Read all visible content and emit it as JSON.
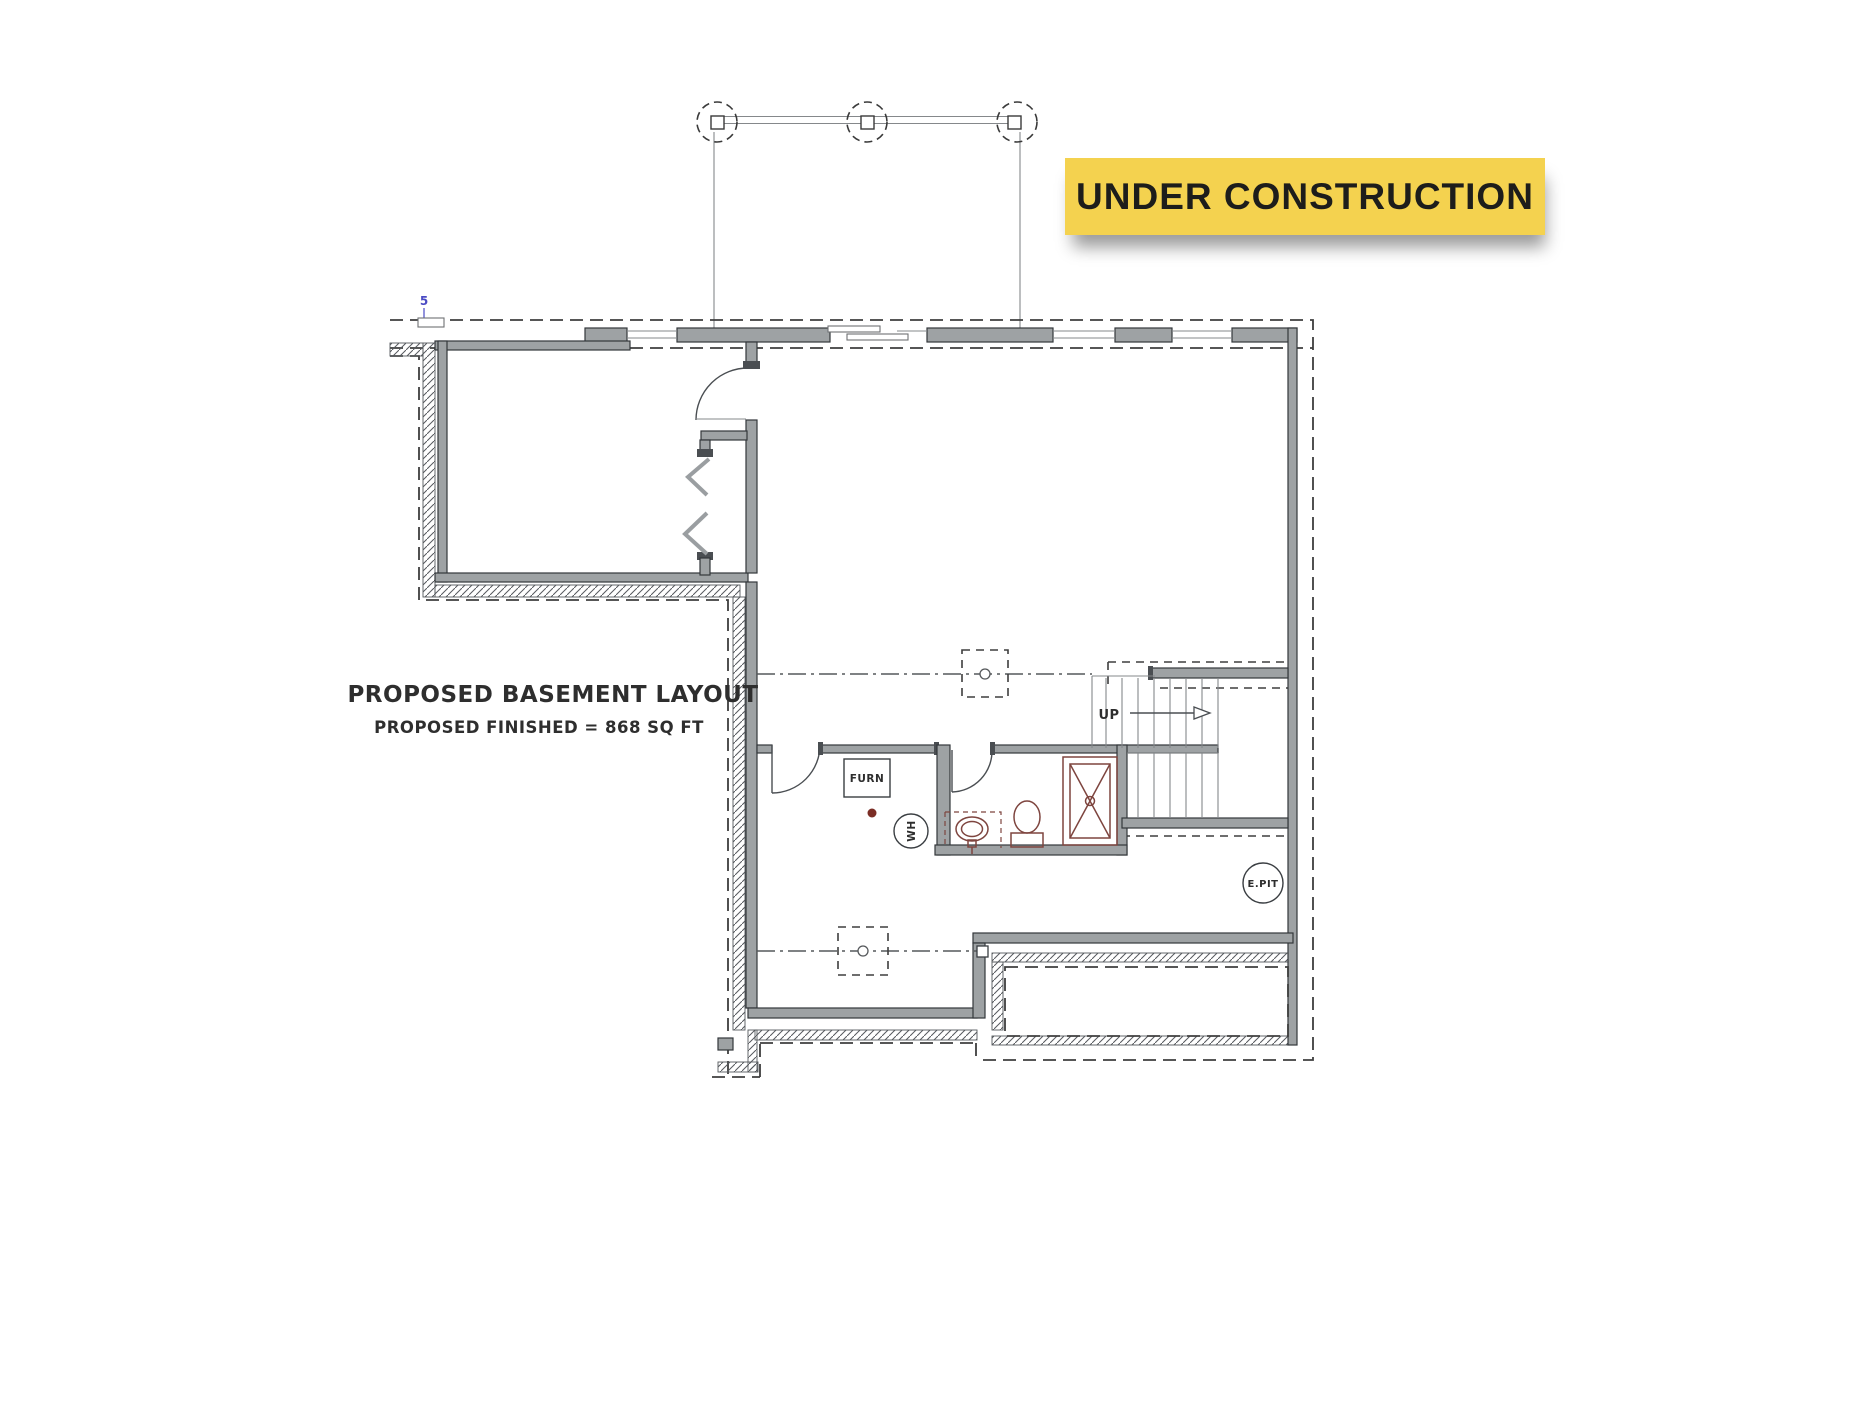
{
  "banner": {
    "label": "UNDER CONSTRUCTION"
  },
  "titles": {
    "main": "PROPOSED BASEMENT LAYOUT",
    "sub": "PROPOSED FINISHED = 868 SQ FT"
  },
  "labels": {
    "furnace": "FURN",
    "water_heater": "WH",
    "stairs_direction": "UP",
    "elevator_pit": "E.PIT",
    "grid_marker": "5"
  },
  "colors": {
    "banner_bg": "#F4D24F",
    "banner_text": "#1D1D1B",
    "wall_fill": "#9EA2A4",
    "wall_stroke": "#33373B",
    "dashed": "#3E3E3E",
    "fixture": "#7E453F",
    "fixture_dark": "#7B2D25",
    "accent_blue": "#4A4AC4",
    "ink": "#2E2E2E"
  }
}
